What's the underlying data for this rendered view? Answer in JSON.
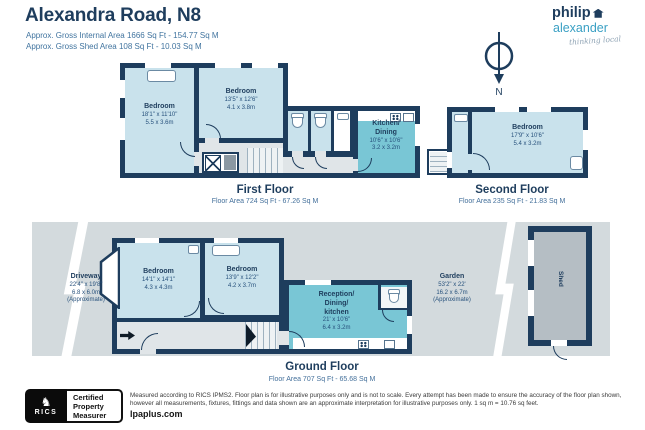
{
  "header": {
    "title": "Alexandra Road, N8",
    "subtitle1": "Approx. Gross Internal Area 1666 Sq Ft - 154.77 Sq M",
    "subtitle2": "Approx. Gross Shed Area 108 Sq Ft - 10.03 Sq M"
  },
  "logo": {
    "name_top": "philip",
    "name_bottom": "alexander",
    "tagline": "thinking local"
  },
  "compass": {
    "label": "N"
  },
  "floors": {
    "first": {
      "title": "First Floor",
      "area": "Floor Area 724 Sq Ft - 67.26 Sq M",
      "rooms": [
        {
          "lines": [
            "Bedroom",
            "18'1\" x 11'10\"",
            "5.5 x 3.6m"
          ]
        },
        {
          "lines": [
            "Bedroom",
            "13'5\" x 12'6\"",
            "4.1 x 3.8m"
          ]
        },
        {
          "lines": [
            "Kitchen/",
            "Dining",
            "10'6\" x 10'6\"",
            "3.2 x 3.2m"
          ]
        }
      ]
    },
    "second": {
      "title": "Second Floor",
      "area": "Floor Area 235 Sq Ft - 21.83 Sq M",
      "rooms": [
        {
          "lines": [
            "Bedroom",
            "17'9\" x 10'6\"",
            "5.4 x 3.2m"
          ]
        }
      ]
    },
    "ground": {
      "title": "Ground Floor",
      "area": "Floor Area 707 Sq Ft - 65.68 Sq M",
      "rooms": [
        {
          "lines": [
            "Bedroom",
            "14'1\" x 14'1\"",
            "4.3 x 4.3m"
          ]
        },
        {
          "lines": [
            "Bedroom",
            "13'9\" x 12'2\"",
            "4.2 x 3.7m"
          ]
        },
        {
          "lines": [
            "Reception/",
            "Dining/",
            "kitchen",
            "21' x 10'6\"",
            "6.4 x 3.2m"
          ]
        }
      ],
      "driveway": {
        "lines": [
          "Driveway",
          "22'4\" x 19'8\"",
          "6.8 x 6.0m",
          "(Approximate)"
        ]
      },
      "garden": {
        "lines": [
          "Garden",
          "53'2\" x 22'",
          "16.2 x 6.7m",
          "(Approximate)"
        ]
      },
      "shed": "Shed"
    }
  },
  "footer": {
    "rics_emblem": "♞",
    "rics_name": "RICS",
    "badge": [
      "Certified",
      "Property",
      "Measurer"
    ],
    "disclaimer1": "Measured according to RICS IPMS2. Floor plan is for illustrative purposes only and is not to scale. Every attempt has been made to ensure the accuracy of the floor plan shown,",
    "disclaimer2": "however all measurements, fixtures, fittings and data shown are an approximate interpretation for illustrative purposes only. 1 sq m = 10.76 sq feet.",
    "website": "lpaplus.com"
  },
  "colors": {
    "wall_navy": "#1e3d5d",
    "room_blue": "#c9e2ec",
    "room_teal": "#79c6d5",
    "outdoor_gray": "#d3dadd",
    "hall_gray": "#e0e5e8",
    "shed_gray": "#b5bec4",
    "brand_teal": "#3aa0c4",
    "subtitle_blue": "#41749f"
  }
}
